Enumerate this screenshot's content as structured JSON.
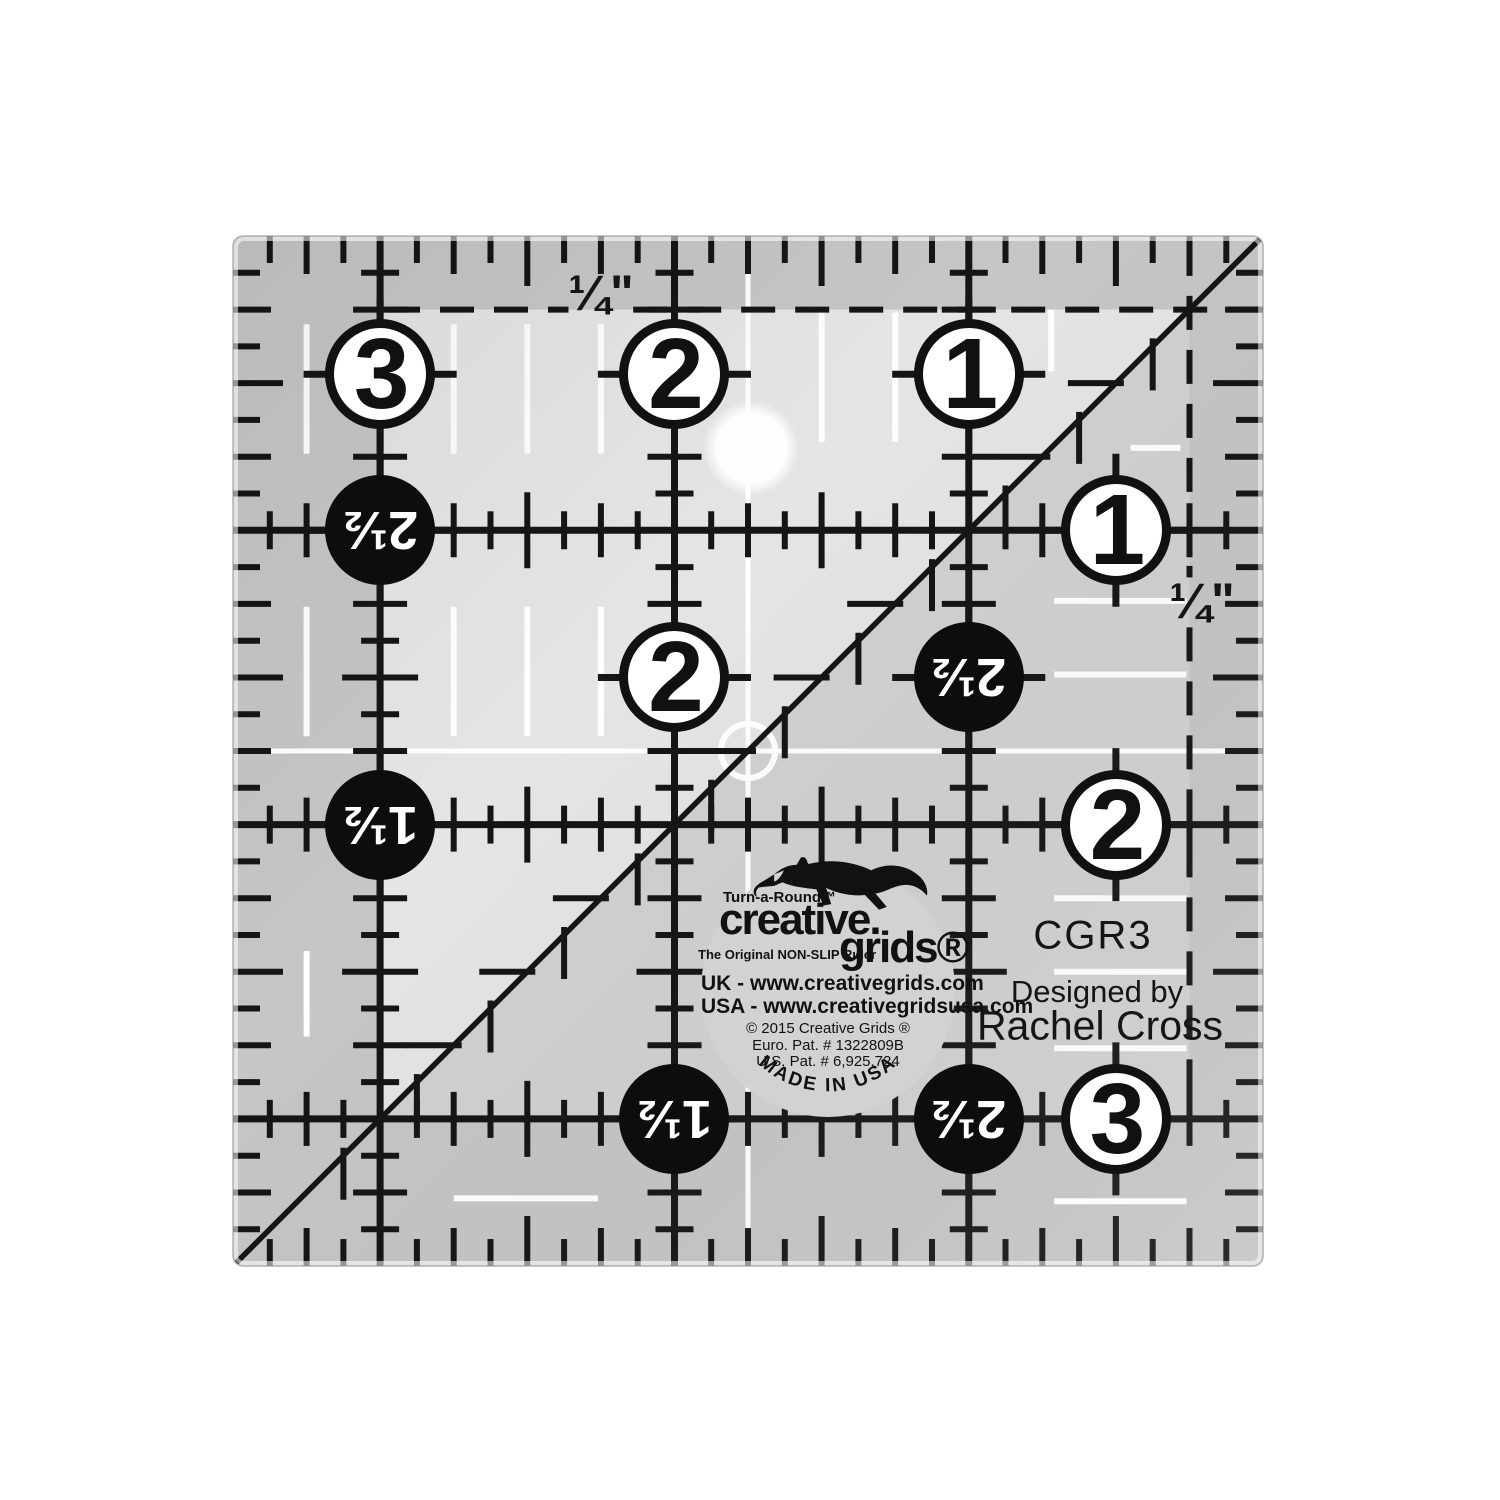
{
  "ruler": {
    "model": "CGR3",
    "designed_by_label": "Designed by",
    "designer": "Rachel Cross",
    "quarter_inch_label": "¼\"",
    "size_inches": 3.5,
    "px_per_inch": 294.3,
    "origin_x": 233,
    "origin_y": 236,
    "colors": {
      "body_light": "#e5e5e5",
      "body_dark": "#c6c6c6",
      "triangle": "#d1d1d1",
      "ink": "#151515",
      "white_mark": "#ffffff",
      "logo_disc": "#d2d2d2",
      "edge_line": "#b5b5b5"
    },
    "grid": {
      "vertical_lines_in": [
        0.5,
        1.5,
        2.5
      ],
      "horizontal_lines_in": [
        1,
        2,
        3
      ],
      "dashed_top_y_in": 0.25,
      "dashed_right_x_in": 3.25,
      "diagonal": [
        [
          0,
          3.5
        ],
        [
          3.5,
          0
        ]
      ],
      "center_cross_in": 1.75
    },
    "circles": [
      {
        "label": "3",
        "style": "white",
        "x": 0.5,
        "y": 0.47
      },
      {
        "label": "2",
        "style": "white",
        "x": 1.5,
        "y": 0.47
      },
      {
        "label": "1",
        "style": "white",
        "x": 2.5,
        "y": 0.47
      },
      {
        "label": "1",
        "style": "white",
        "x": 3.0,
        "y": 1.0
      },
      {
        "label": "2",
        "style": "white",
        "x": 3.0,
        "y": 2.0
      },
      {
        "label": "3",
        "style": "white",
        "x": 3.0,
        "y": 3.0
      },
      {
        "label": "2",
        "style": "white",
        "x": 1.5,
        "y": 1.5
      },
      {
        "label": "2½",
        "style": "black",
        "x": 2.5,
        "y": 1.5
      },
      {
        "label": "2½",
        "style": "black",
        "x": 0.5,
        "y": 1.0
      },
      {
        "label": "1½",
        "style": "black",
        "x": 0.5,
        "y": 2.0
      },
      {
        "label": "1½",
        "style": "black",
        "x": 1.5,
        "y": 3.0
      },
      {
        "label": "2½",
        "style": "black",
        "x": 2.5,
        "y": 3.0
      }
    ],
    "white_marks": {
      "v_dashes": [
        {
          "x": 0.25,
          "y1": 0.3,
          "y2": 0.74
        },
        {
          "x": 0.75,
          "y1": 0.3,
          "y2": 0.74
        },
        {
          "x": 1.0,
          "y1": 0.3,
          "y2": 0.74
        },
        {
          "x": 1.25,
          "y1": 0.3,
          "y2": 0.74
        },
        {
          "x": 2.0,
          "y1": 0.26,
          "y2": 0.7
        },
        {
          "x": 2.25,
          "y1": 0.26,
          "y2": 0.7
        },
        {
          "x": 2.78,
          "y1": 0.25,
          "y2": 0.46
        },
        {
          "x": 0.25,
          "y1": 1.26,
          "y2": 1.7
        },
        {
          "x": 0.75,
          "y1": 1.26,
          "y2": 1.7
        },
        {
          "x": 1.0,
          "y1": 1.26,
          "y2": 1.7
        },
        {
          "x": 1.25,
          "y1": 1.26,
          "y2": 1.7
        },
        {
          "x": 0.25,
          "y1": 2.43,
          "y2": 2.72
        }
      ],
      "h_dashes": [
        {
          "y": 0.72,
          "x1": 3.05,
          "x2": 3.22
        },
        {
          "y": 1.24,
          "x1": 2.79,
          "x2": 3.24
        },
        {
          "y": 1.49,
          "x1": 2.79,
          "x2": 3.24
        },
        {
          "y": 2.25,
          "x1": 2.79,
          "x2": 3.24
        },
        {
          "y": 2.5,
          "x1": 2.79,
          "x2": 3.24
        },
        {
          "y": 2.76,
          "x1": 2.79,
          "x2": 3.24
        },
        {
          "y": 3.28,
          "x1": 2.79,
          "x2": 3.24
        },
        {
          "y": 3.27,
          "x1": 0.75,
          "x2": 1.24
        }
      ],
      "center_circle_r_px": 27,
      "hole": {
        "x": 1.76,
        "y": 0.72,
        "r_px": 48
      }
    }
  },
  "logo": {
    "turn_a_round": "Turn-a-Round™",
    "brand_line1": "creative.",
    "brand_line2": "grids®",
    "tagline": "The Original NON-SLIP Ruler",
    "uk_line": "UK - www.creativegrids.com",
    "usa_line": "USA - www.creativegridsusa.com",
    "copyright": "© 2015 Creative Grids ®",
    "euro_patent": "Euro. Pat. # 1322809B",
    "us_patent": "U.S. Pat. # 6,925,724",
    "made_in": "MADE IN USA"
  }
}
